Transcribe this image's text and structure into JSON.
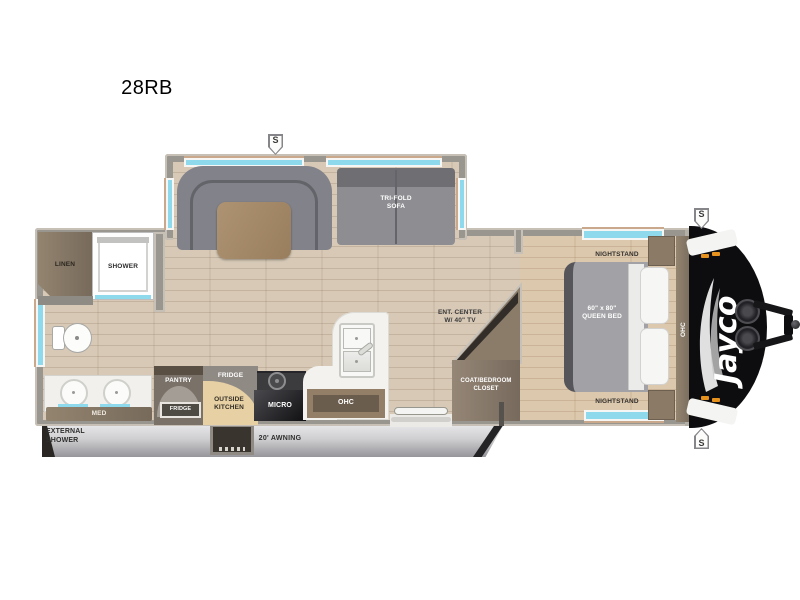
{
  "title": "28RB",
  "brand": {
    "wordmark": "Jayco"
  },
  "badges": {
    "slide_top": "S",
    "front_top": "S",
    "front_bottom": "S"
  },
  "bathroom": {
    "linen": "LINEN",
    "shower": "SHOWER",
    "med": "MED"
  },
  "kitchen": {
    "pantry": "PANTRY",
    "fridge": "FRIDGE",
    "fridge_box": "FRIDGE",
    "outside_kitchen": "OUTSIDE\nKITCHEN",
    "micro": "MICRO",
    "ohc": "OHC"
  },
  "living": {
    "trifold_sofa": "TRI-FOLD\nSOFA",
    "ent_center": "ENT. CENTER\nW/ 40\" TV"
  },
  "bedroom": {
    "nightstand_top": "NIGHTSTAND",
    "nightstand_bottom": "NIGHTSTAND",
    "queen_bed": "60\" x 80\"\nQUEEN BED",
    "closet": "COAT/BEDROOM\nCLOSET",
    "ohc": "OHC"
  },
  "exterior": {
    "awning": "20' AWNING",
    "external_shower": "EXTERNAL\nSHOWER"
  },
  "colors": {
    "floor": "#d7c9b6",
    "bedroom_floor": "#dcc8ad",
    "wall": "#99958f",
    "window": "#8ed9ec",
    "sofa": "#8d8d92",
    "table_wood": "#a78c6b",
    "cabinet_wood": "#7d7063",
    "counter": "#f3f2ee",
    "outside_kitchen": "#e6d0a4",
    "front_cap": "#0d0d0f",
    "marker_light": "#e8921e"
  }
}
